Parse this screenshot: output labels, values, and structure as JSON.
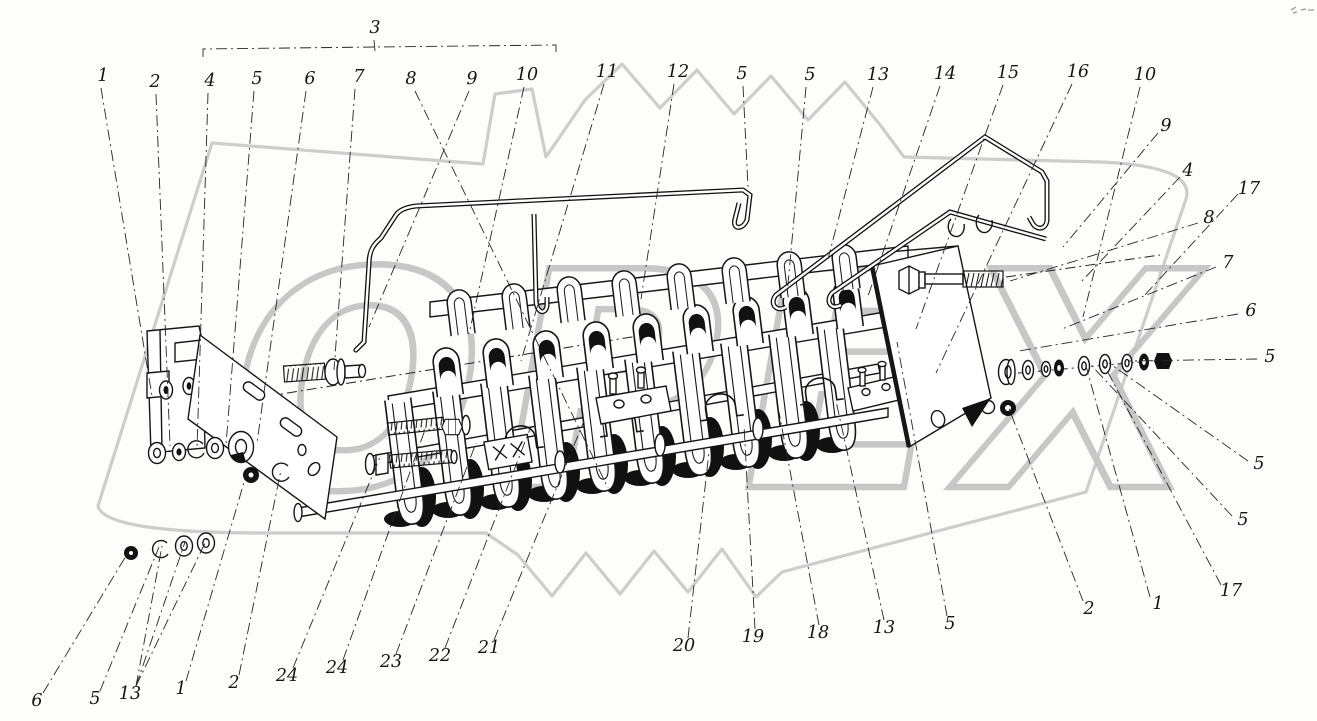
{
  "watermark": {
    "text": "ОРЕХ",
    "color": "#c5c5c5"
  },
  "figure": {
    "bracket": {
      "points": "203,57 203,49 375,47 556,45 556,54"
    },
    "callouts": [
      {
        "t": "3",
        "x": 375,
        "y": 28,
        "l": [
          374,
          40,
          375,
          51
        ]
      },
      {
        "t": "1",
        "x": 103,
        "y": 76,
        "l": [
          101,
          88,
          152,
          396
        ]
      },
      {
        "t": "2",
        "x": 155,
        "y": 82,
        "l": [
          156,
          94,
          170,
          446
        ]
      },
      {
        "t": "4",
        "x": 210,
        "y": 81,
        "l": [
          208,
          93,
          197,
          449
        ]
      },
      {
        "t": "5",
        "x": 257,
        "y": 79,
        "l": [
          254,
          91,
          226,
          445
        ]
      },
      {
        "t": "6",
        "x": 310,
        "y": 79,
        "l": [
          306,
          91,
          257,
          443
        ]
      },
      {
        "t": "7",
        "x": 359,
        "y": 77,
        "l": [
          355,
          89,
          334,
          370
        ]
      },
      {
        "t": "8",
        "x": 411,
        "y": 79,
        "l": [
          415,
          91,
          608,
          488
        ]
      },
      {
        "t": "9",
        "x": 472,
        "y": 79,
        "l": [
          469,
          91,
          369,
          327
        ]
      },
      {
        "t": "10",
        "x": 527,
        "y": 75,
        "l": [
          524,
          87,
          469,
          334
        ]
      },
      {
        "t": "11",
        "x": 607,
        "y": 72,
        "l": [
          604,
          84,
          521,
          361
        ]
      },
      {
        "t": "12",
        "x": 678,
        "y": 72,
        "l": [
          674,
          84,
          641,
          299
        ]
      },
      {
        "t": "5",
        "x": 742,
        "y": 74,
        "l": [
          743,
          86,
          748,
          187
        ]
      },
      {
        "t": "5",
        "x": 810,
        "y": 75,
        "l": [
          806,
          87,
          787,
          295
        ]
      },
      {
        "t": "13",
        "x": 878,
        "y": 75,
        "l": [
          873,
          87,
          828,
          259
        ]
      },
      {
        "t": "14",
        "x": 945,
        "y": 74,
        "l": [
          940,
          86,
          867,
          299
        ]
      },
      {
        "t": "15",
        "x": 1008,
        "y": 73,
        "l": [
          1003,
          85,
          916,
          329
        ]
      },
      {
        "t": "16",
        "x": 1078,
        "y": 72,
        "l": [
          1072,
          84,
          936,
          373
        ]
      },
      {
        "t": "10",
        "x": 1145,
        "y": 75,
        "l": [
          1140,
          87,
          1083,
          317
        ]
      },
      {
        "t": "9",
        "x": 1166,
        "y": 126,
        "l": [
          1158,
          133,
          1063,
          247
        ]
      },
      {
        "t": "4",
        "x": 1188,
        "y": 171,
        "l": [
          1180,
          177,
          1081,
          282
        ]
      },
      {
        "t": "17",
        "x": 1249,
        "y": 189,
        "l": [
          1238,
          194,
          1143,
          297
        ]
      },
      {
        "t": "8",
        "x": 1209,
        "y": 218,
        "l": [
          1198,
          223,
          1010,
          281
        ]
      },
      {
        "t": "7",
        "x": 1228,
        "y": 263,
        "l": [
          1216,
          267,
          1062,
          329
        ]
      },
      {
        "t": "6",
        "x": 1251,
        "y": 311,
        "l": [
          1238,
          314,
          1019,
          351
        ]
      },
      {
        "t": "5",
        "x": 1270,
        "y": 357,
        "l": [
          1257,
          359,
          1129,
          361
        ]
      },
      {
        "t": "5",
        "x": 1259,
        "y": 464,
        "l": [
          1248,
          461,
          1109,
          363
        ]
      },
      {
        "t": "5",
        "x": 1243,
        "y": 520,
        "l": [
          1232,
          516,
          1091,
          365
        ]
      },
      {
        "t": "17",
        "x": 1231,
        "y": 591,
        "l": [
          1221,
          585,
          1104,
          365
        ]
      },
      {
        "t": "1",
        "x": 1158,
        "y": 604,
        "l": [
          1150,
          597,
          1086,
          366
        ]
      },
      {
        "t": "2",
        "x": 1089,
        "y": 609,
        "l": [
          1083,
          601,
          1008,
          406
        ]
      },
      {
        "t": "6",
        "x": 37,
        "y": 701,
        "l": [
          43,
          693,
          129,
          551
        ]
      },
      {
        "t": "5",
        "x": 95,
        "y": 699,
        "l": [
          100,
          691,
          159,
          547
        ]
      },
      {
        "t": "13",
        "x": 130,
        "y": 694,
        "l": [
          136,
          686,
          162,
          546
        ],
        "extra": [
          [
            136,
            686,
            185,
            542
          ],
          [
            136,
            686,
            207,
            539
          ]
        ]
      },
      {
        "t": "1",
        "x": 181,
        "y": 689,
        "l": [
          186,
          681,
          247,
          472
        ]
      },
      {
        "t": "2",
        "x": 234,
        "y": 683,
        "l": [
          239,
          675,
          281,
          470
        ]
      },
      {
        "t": "24",
        "x": 287,
        "y": 676,
        "l": [
          293,
          668,
          380,
          457
        ]
      },
      {
        "t": "24",
        "x": 337,
        "y": 668,
        "l": [
          343,
          660,
          426,
          427
        ]
      },
      {
        "t": "23",
        "x": 391,
        "y": 662,
        "l": [
          396,
          654,
          476,
          443
        ]
      },
      {
        "t": "22",
        "x": 440,
        "y": 656,
        "l": [
          445,
          648,
          530,
          429
        ]
      },
      {
        "t": "21",
        "x": 489,
        "y": 648,
        "l": [
          494,
          640,
          584,
          421
        ]
      },
      {
        "t": "20",
        "x": 684,
        "y": 646,
        "l": [
          688,
          638,
          709,
          452
        ]
      },
      {
        "t": "19",
        "x": 753,
        "y": 637,
        "l": [
          755,
          629,
          744,
          425
        ]
      },
      {
        "t": "18",
        "x": 818,
        "y": 633,
        "l": [
          819,
          625,
          779,
          412
        ]
      },
      {
        "t": "13",
        "x": 884,
        "y": 628,
        "l": [
          884,
          620,
          836,
          401
        ]
      },
      {
        "t": "5",
        "x": 950,
        "y": 624,
        "l": [
          947,
          616,
          897,
          342
        ]
      }
    ]
  }
}
